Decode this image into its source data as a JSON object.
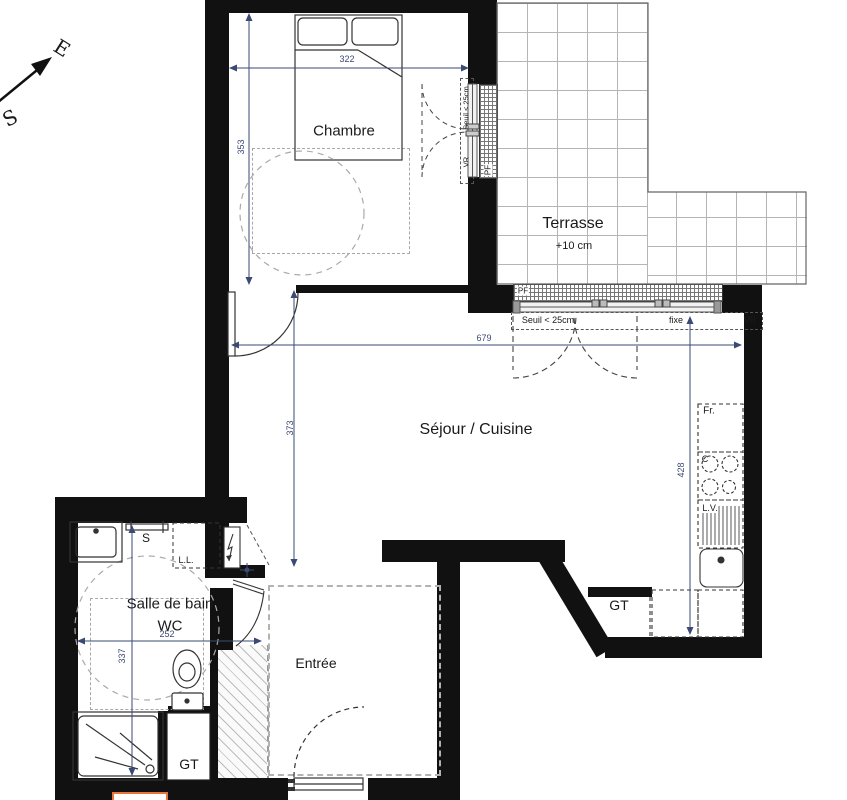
{
  "compass": {
    "east": "E",
    "south": "S"
  },
  "rooms": {
    "chambre": {
      "name": "Chambre"
    },
    "terrasse": {
      "name": "Terrasse",
      "elevation": "+10 cm"
    },
    "sejour_cuisine": {
      "name": "Séjour / Cuisine"
    },
    "salle_de_bain": {
      "line1": "Salle de bain",
      "line2": "WC"
    },
    "entree": {
      "name": "Entrée"
    }
  },
  "dimensions_cm": {
    "chambre_width": "322",
    "chambre_depth": "353",
    "sejour_width": "679",
    "sejour_depth": "373",
    "cuisine_depth": "428",
    "sdb_width": "252",
    "sdb_depth": "337"
  },
  "windows": {
    "chambre_door": {
      "type_label": "PF",
      "threshold": "Seuil < 25cm",
      "shutter": "VR"
    },
    "sejour_bay": {
      "type_label": "PF",
      "threshold": "Seuil < 25cm",
      "fixed_panel": "fixe",
      "shutter": "VR"
    }
  },
  "fixtures": {
    "fridge": "Fr.",
    "cooktop": "C",
    "dishwasher": "L.V.",
    "washing_machine": "L.L.",
    "towel_dryer": "S",
    "duct_kitchen": "GT",
    "duct_bathroom": "GT"
  },
  "colors": {
    "wall": "#111111",
    "dim_text": "#3a4a75",
    "tile_line": "#b5b5b5",
    "dash": "#999999",
    "legend_accent": "#e8743b"
  }
}
